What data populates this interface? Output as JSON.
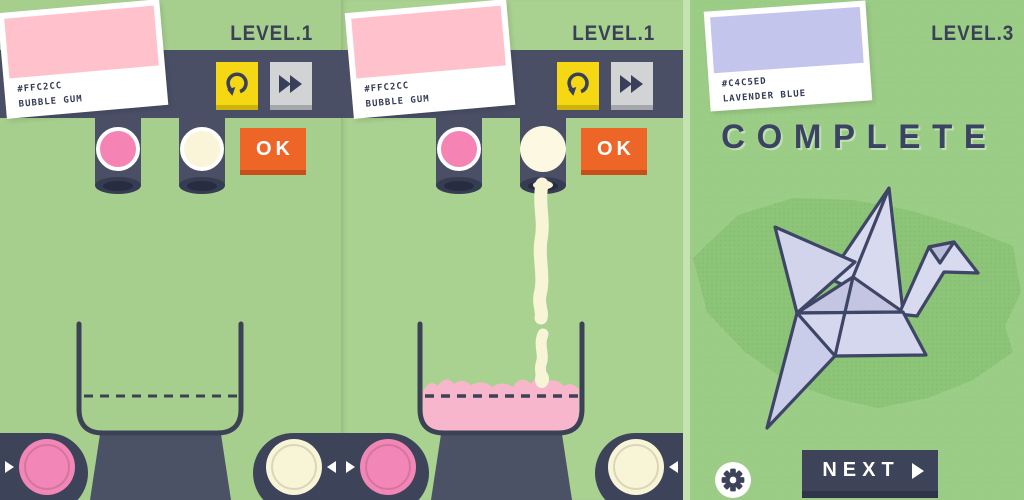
{
  "panels": [
    {
      "level_label": "LEVEL.1",
      "swatch_hex": "#FFC2CC",
      "swatch_name": "BUBBLE GUM",
      "ok_label": "OK",
      "state": "ready",
      "left_dispenser_color": "#F584B4",
      "right_dispenser_color": "#FAF5D8"
    },
    {
      "level_label": "LEVEL.1",
      "swatch_hex": "#FFC2CC",
      "swatch_name": "BUBBLE GUM",
      "ok_label": "OK",
      "state": "pouring-cream-into-pink",
      "left_dispenser_color": "#F584B4",
      "right_dispenser_color": "#FAF5D8"
    },
    {
      "level_label": "LEVEL.3",
      "swatch_hex": "#C4C5ED",
      "swatch_name": "LAVENDER BLUE",
      "complete_label": "COMPLETE",
      "next_label": "NEXT",
      "state": "complete"
    }
  ],
  "icons": {
    "undo": "circular-counterclockwise-arrow",
    "fast_forward": "double-right-triangles",
    "settings": "gear",
    "next": "right-triangle",
    "swipe_right": "small-right-triangle",
    "swipe_left": "small-left-triangle"
  },
  "colors": {
    "background_green": "#A6CE8D",
    "background_green_textured": "#9CCD87",
    "bar_navy": "#4A4F66",
    "dark_navy": "#3B4158",
    "accent_yellow": "#F6D714",
    "accent_gray": "#D2D3D5",
    "accent_orange": "#ED6527",
    "bubble_gum_pink": "#F584B4",
    "cream": "#FAF5D8",
    "pink_liquid": "#F8B6CD",
    "lavender": "#C4C5ED",
    "crane_paper": "#D6D8EE",
    "white": "#FFFFFF"
  }
}
